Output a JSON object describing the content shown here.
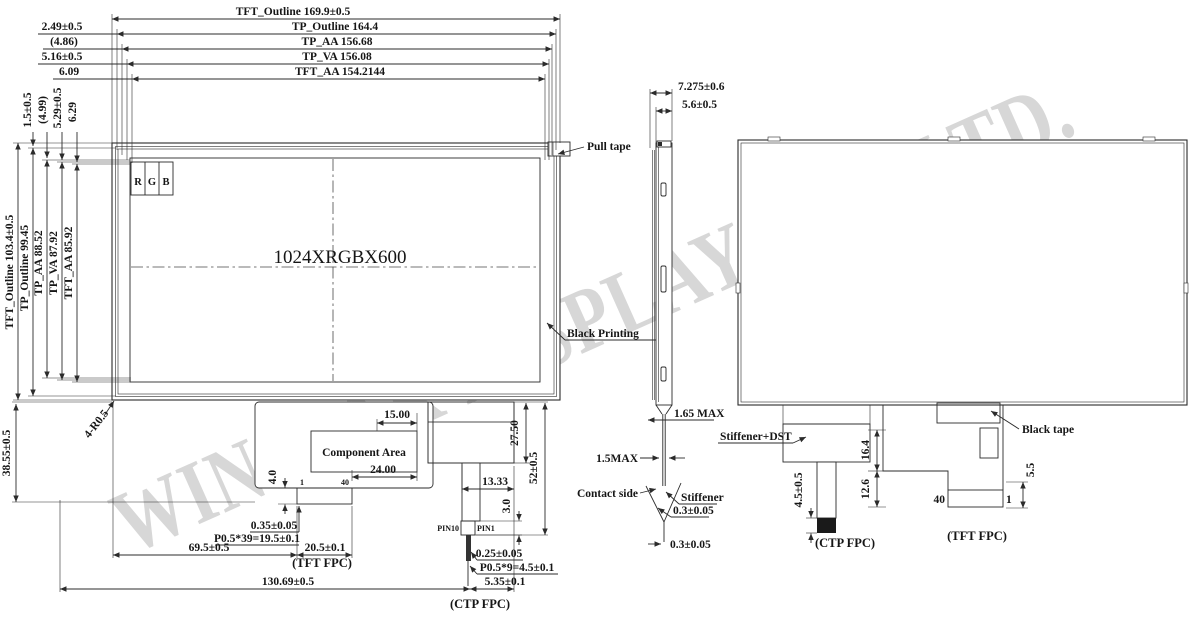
{
  "watermark": "WINSTAR DISPLAY CO., LTD.",
  "front_view": {
    "pixel_format": "1024XRGBX600",
    "rgb": {
      "r": "R",
      "g": "G",
      "b": "B"
    },
    "pull_tape": "Pull tape",
    "black_printing": "Black Printing",
    "corner_radius": "4-R0.5",
    "height_total": "38.55±0.5",
    "width_total": "130.69±0.5",
    "top_dims": {
      "tft_outline": "TFT_Outline 169.9±0.5",
      "tp_outline": "TP_Outline 164.4",
      "tp_aa": "TP_AA 156.68",
      "tp_va": "TP_VA 156.08",
      "tft_aa": "TFT_AA 154.2144"
    },
    "top_offsets": {
      "tp_outline": "2.49±0.5",
      "tp_aa": "(4.86)",
      "tp_va": "5.16±0.5",
      "tft_aa": "6.09"
    },
    "left_dims": {
      "tft_outline": "TFT_Outline 103.4±0.5",
      "tp_outline": "TP_Outline 99.45",
      "tp_aa": "TP_AA 88.52",
      "tp_va": "TP_VA 87.92",
      "tft_aa": "TFT_AA 85.92"
    },
    "left_offsets": {
      "tp_outline": "1.5±0.5",
      "tp_aa": "(4.99)",
      "tp_va": "5.29±0.5",
      "tft_aa": "6.29"
    },
    "tft_fpc": {
      "label": "(TFT FPC)",
      "component_area": "Component Area",
      "dim_15": "15.00",
      "dim_24": "24.00",
      "dim_4": "4.0",
      "pin_width": "0.35±0.05",
      "pitch": "P0.5*39=19.5±0.1",
      "offset": "69.5±0.5",
      "width": "20.5±0.1",
      "pin_first": "1",
      "pin_last": "40"
    },
    "ctp_fpc": {
      "label": "(CTP FPC)",
      "dim_2750": "27.50",
      "dim_52": "52±0.5",
      "dim_1333": "13.33",
      "dim_3": "3.0",
      "pin_width": "0.25±0.05",
      "pitch": "P0.5*9=4.5±0.1",
      "tail": "5.35±0.1",
      "pin_left": "PIN10",
      "pin_right": "PIN1"
    }
  },
  "side_view": {
    "thickness_total": "7.275±0.6",
    "thickness_panel": "5.6±0.5",
    "dim_165": "1.65 MAX",
    "dim_15": "1.5MAX",
    "contact_side": "Contact side",
    "stiffener": "Stiffener",
    "dim_03_upper": "0.3±0.05",
    "dim_03_lower": "0.3±0.05"
  },
  "back_view": {
    "stiffener_dst": "Stiffener+DST",
    "black_tape": "Black tape",
    "dim_164": "16.4",
    "dim_126": "12.6",
    "dim_45": "4.5±0.5",
    "dim_55": "5.5",
    "pin_40": "40",
    "pin_1": "1",
    "ctp_label": "(CTP FPC)",
    "tft_label": "(TFT FPC)"
  }
}
